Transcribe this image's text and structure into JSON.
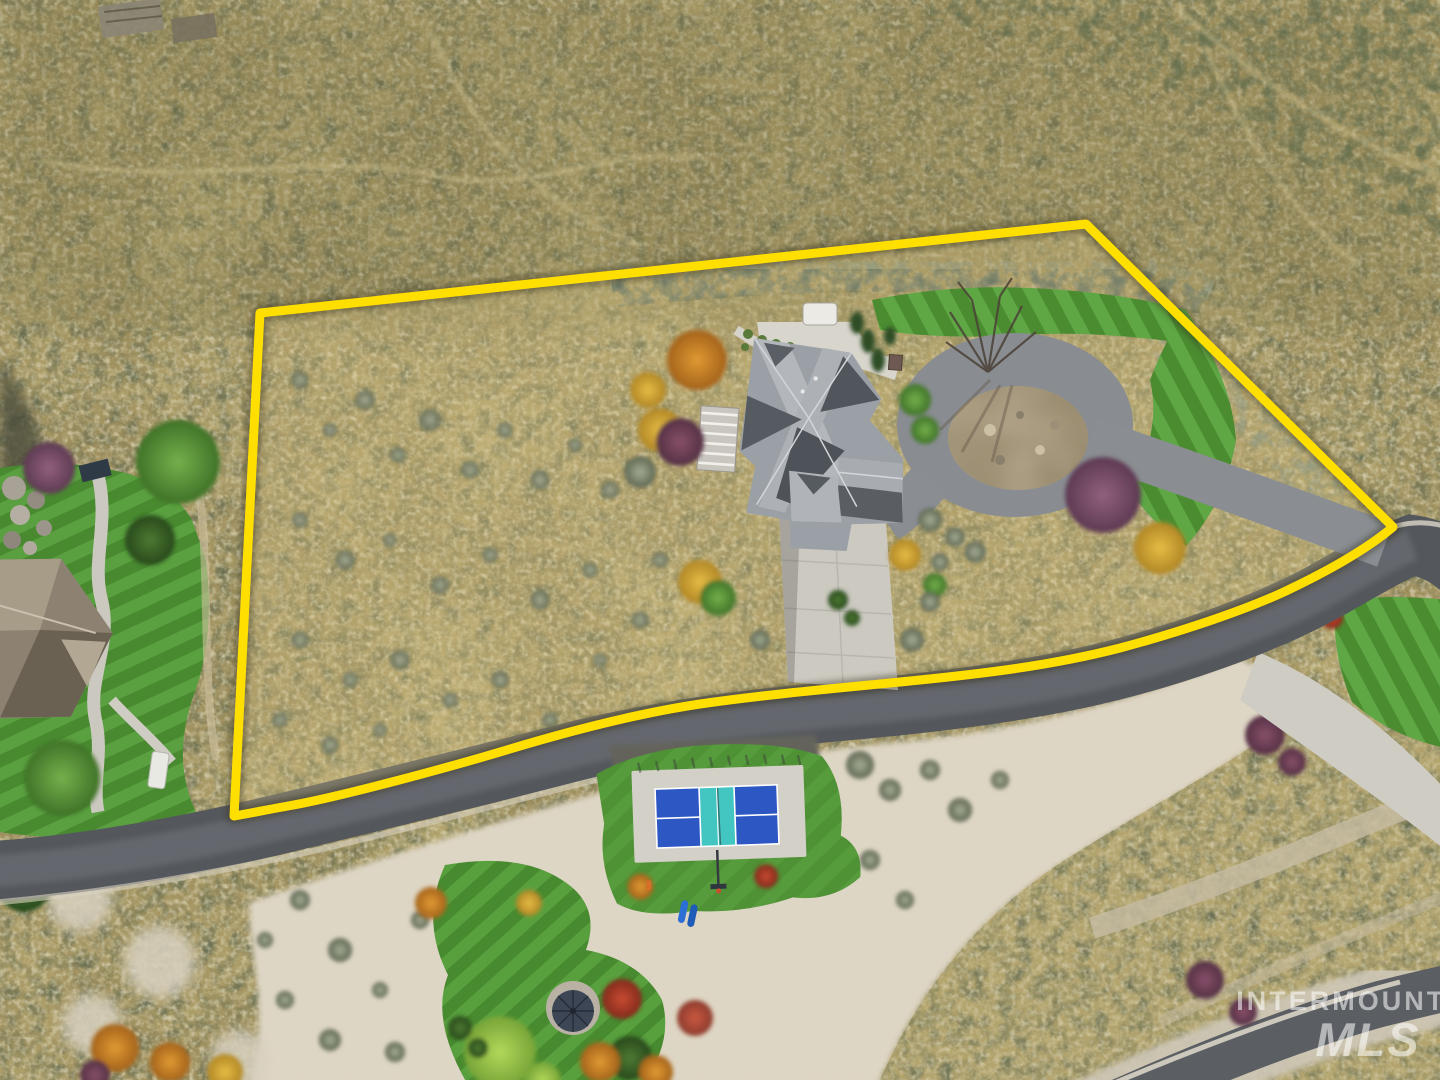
{
  "scene": {
    "type": "aerial-drone-photograph",
    "subject": "hillside residential lot outlined with a property boundary, home with circular driveway, pickleball court below the road",
    "boundary_color": "#ffdf00",
    "road_color": "#54575c",
    "scrub_color": "#b5a66f",
    "sand_color": "#ded6c5",
    "lawn_color": "#55963a",
    "roof_light": "#b3b7bc",
    "roof_dark": "#51565c",
    "court": {
      "side": "#2d58c4",
      "kitchen": "#43c5c1",
      "line": "#ffffff",
      "apron": "#d3d0c8"
    }
  },
  "watermark": {
    "line1": "INTERMOUNTAIN",
    "line2": "MLS",
    "color": "#ffffff"
  }
}
